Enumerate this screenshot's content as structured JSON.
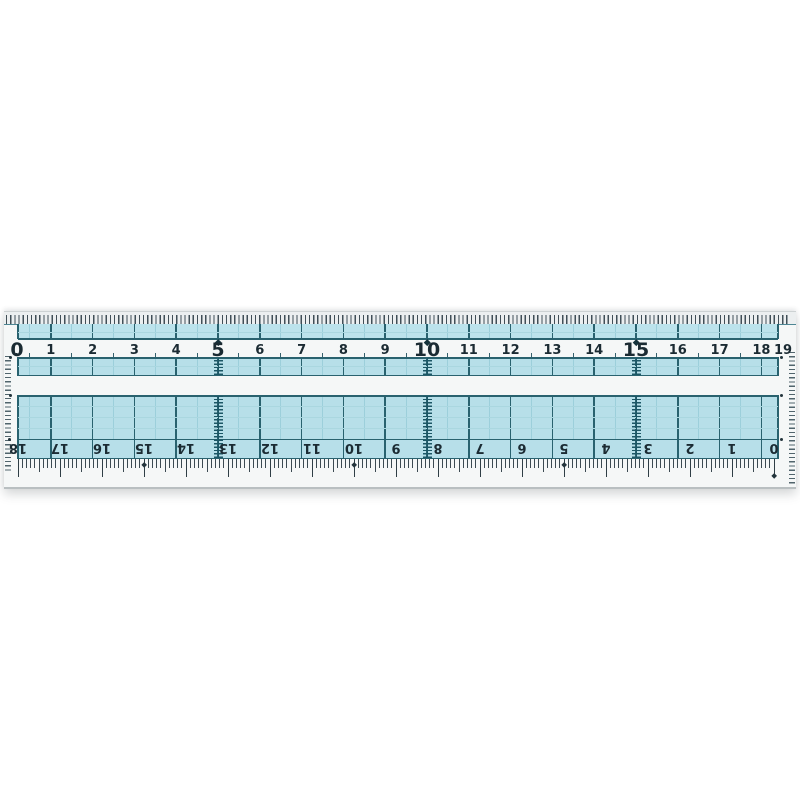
{
  "image": {
    "description": "Product photo of a transparent plastic ruler with light-blue printed measuring grid on a white background"
  },
  "ruler": {
    "brand": "KUTSUWA",
    "top_scale": {
      "unit": "cm",
      "labels": [
        "0",
        "1",
        "2",
        "3",
        "4",
        "5",
        "6",
        "7",
        "8",
        "9",
        "10",
        "11",
        "12",
        "13",
        "14",
        "15",
        "16",
        "17",
        "18",
        "19"
      ],
      "emphasized": [
        "0",
        "5",
        "10",
        "15"
      ]
    },
    "bottom_scale": {
      "unit": "cm",
      "labels_left_to_right": [
        "18",
        "17",
        "16",
        "15",
        "14",
        "13",
        "12",
        "11",
        "10",
        "9",
        "8",
        "7",
        "6",
        "5",
        "4",
        "3",
        "2",
        "1",
        "0"
      ],
      "orientation": "inverted-180deg, zero at right edge"
    },
    "marker_positions_cm": [
      "5",
      "10",
      "15"
    ],
    "colors": {
      "grid_blue_fill": "#b7dfe9",
      "grid_blue_fill_light": "#bce3ec",
      "grid_line_dark": "#29626f",
      "grid_line_half": "#9ccfdb",
      "grid_line_faint": "#aad7e0",
      "digit_color": "#1b2b33",
      "body_white": "#f5f7f7",
      "tick_dark": "#3c4a52"
    }
  }
}
